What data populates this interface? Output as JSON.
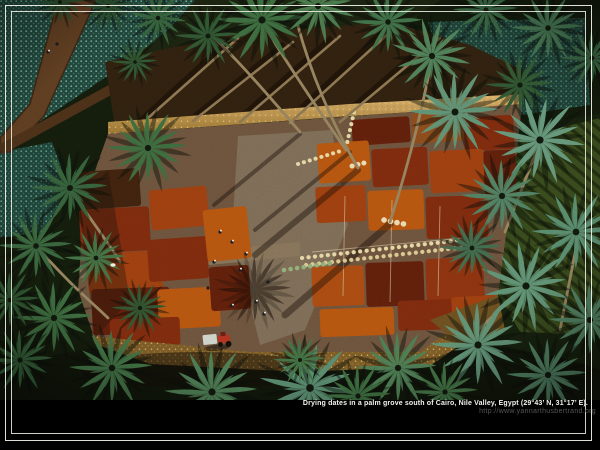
{
  "photo": {
    "alt": "Aerial photograph of dates drying in red, orange and brown patches on a cleared field inside a date-palm grove, with workers, white sacks in rows, a tractor, and surrounding palm trees and teal crop fields",
    "caption": "Drying dates in a palm grove south of Cairo, Nile Valley, Egypt (29°43’ N, 31°17’ E).",
    "credit_url": "http://www.yannarthusbertrand.org"
  },
  "frame": {
    "matte_color": "#000000",
    "keyline_color": "#f3f3ec",
    "style": "double keyline"
  },
  "palette": {
    "palm_green_dark": "#2f5531",
    "palm_green_teal": "#5e8f72",
    "teal_field": "#21443a",
    "clearing_ground": "#6b523c",
    "date_orange": "#b45410",
    "date_rust": "#9c3e10",
    "date_maroon": "#5f1f0b",
    "straw_gold": "#c8a05e",
    "caption_text": "#f4f4ee",
    "url_text": "#565656"
  }
}
